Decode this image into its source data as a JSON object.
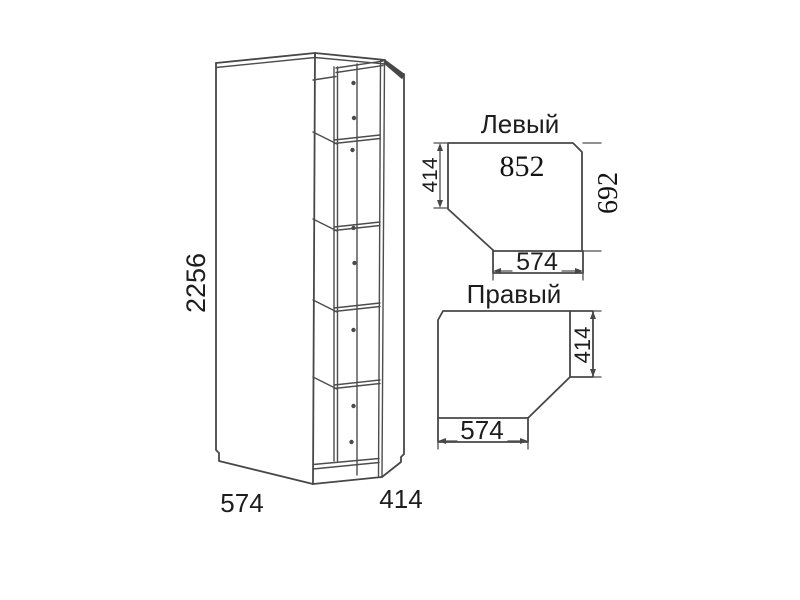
{
  "drawing_type": "corner-wardrobe-technical-drawing",
  "colors": {
    "background": "#ffffff",
    "line": "#474747",
    "text": "#1d1d1d"
  },
  "cabinet_view": {
    "height": "2256",
    "front_width": "574",
    "side_depth": "414"
  },
  "left_plan": {
    "title": "Левый",
    "back_width": "852",
    "left_depth": "414",
    "right_depth": "692",
    "front_width": "574"
  },
  "right_plan": {
    "title": "Правый",
    "right_depth": "414",
    "front_width": "574"
  }
}
